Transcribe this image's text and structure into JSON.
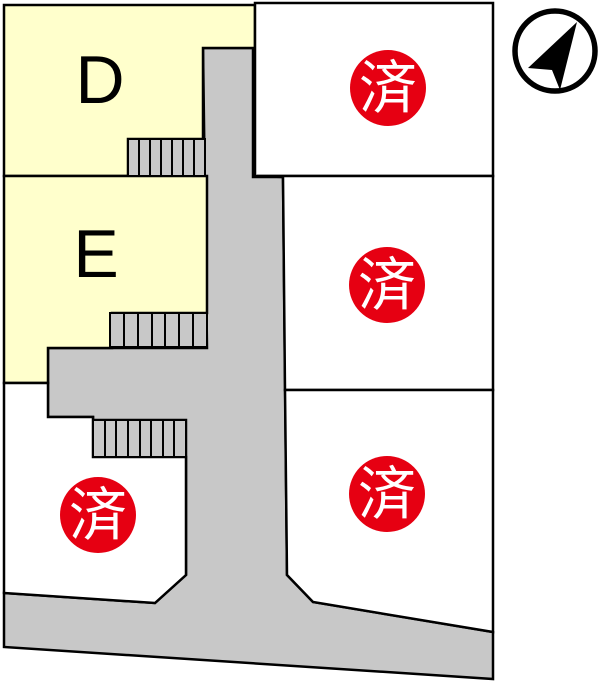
{
  "map": {
    "title": "lot-layout-map",
    "sold_mark": "済",
    "colors": {
      "available_fill": "#ffffcc",
      "vacant_fill": "#ffffff",
      "road_fill": "#c8c8c8",
      "steps_fill": "#c8c8c8",
      "outline": "#000000",
      "sold_badge": "#e60012",
      "badge_text": "#ffffff",
      "compass_color": "#000000"
    },
    "plots": [
      {
        "id": "plot-d",
        "label": "D",
        "status": "available"
      },
      {
        "id": "plot-e",
        "label": "E",
        "status": "available"
      },
      {
        "id": "plot-top-right",
        "label": "",
        "status": "sold",
        "mark": "済"
      },
      {
        "id": "plot-middle-right",
        "label": "",
        "status": "sold",
        "mark": "済"
      },
      {
        "id": "plot-bottom-right",
        "label": "",
        "status": "sold",
        "mark": "済"
      },
      {
        "id": "plot-bottom-left",
        "label": "",
        "status": "sold",
        "mark": "済"
      }
    ]
  }
}
